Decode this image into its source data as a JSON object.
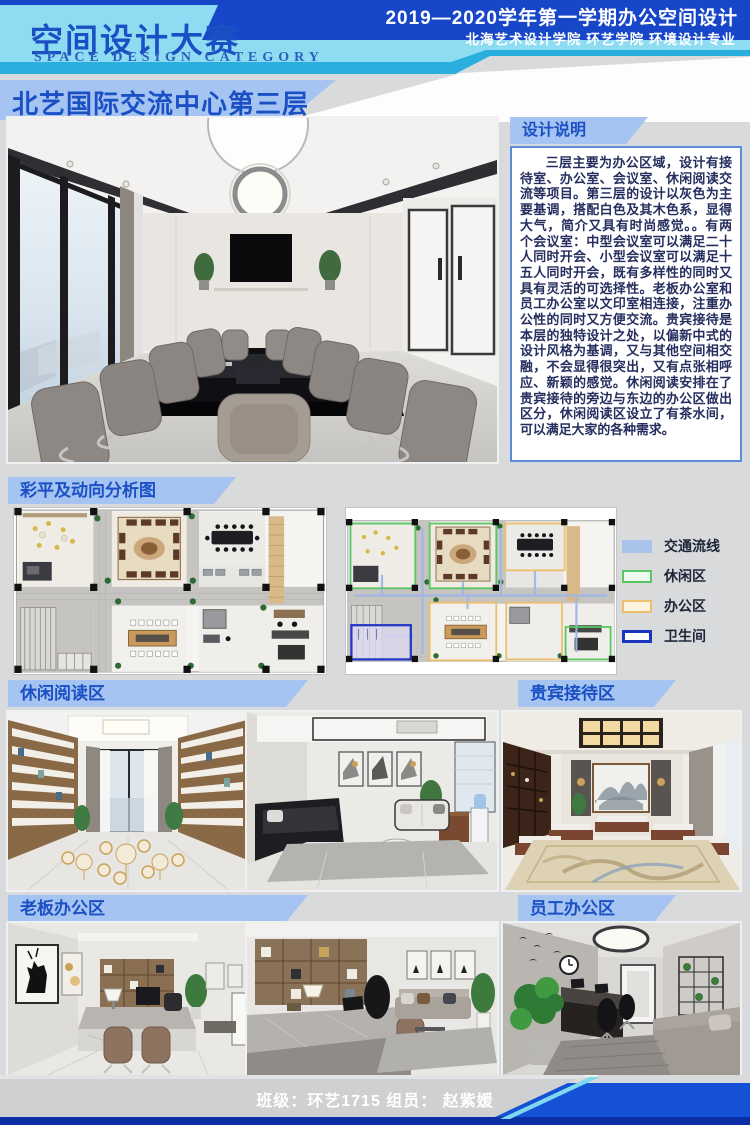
{
  "header": {
    "title": "空间设计大赛",
    "subtitle": "SPACE DESIGN CATEGORY",
    "session_line": "2019—2020学年第一学期办公空间设计",
    "school_line": "北海艺术设计学院 环艺学院 环境设计专业",
    "banner_main": "北艺国际交流中心",
    "banner_em": "第三层",
    "colors": {
      "royal_blue": "#1746c8",
      "light_cyan": "#8edcf2",
      "cyan_strip": "#29aede",
      "periwinkle": "#a6c4f1",
      "title_blue": "#1b50c5"
    }
  },
  "design_notes": {
    "label": "设计说明",
    "text": "三层主要为办公区域，设计有接待室、办公室、会议室、休闲阅读交流等项目。第三层的设计以灰色为主要基调，搭配白色及其木色系，显得大气，简介又具有时尚感觉。。有两个会议室：中型会议室可以满足二十人同时开会、小型会议室可以满足十五人同时开会，既有多样性的同时又具有灵活的可选择性。老板办公室和员工办公室以文印室相连接，注重办公性的同时又方便交流。贵宾接待是本层的独特设计之处，以偏新中式的设计风格为基调，又与其他空间相交融，不会显得很突出，又有点张相呼应、新颖的感觉。休闲阅读安排在了贵宾接待的旁边与东边的办公区做出区分，休闲阅读区设立了有茶水间，可以满足大家的各种需求。"
  },
  "analysis": {
    "label": "彩平及动向分析图",
    "legend": [
      {
        "name": "交通流线",
        "color": "#a9c3ea",
        "style": "solid"
      },
      {
        "name": "休闲区",
        "color": "#58c763",
        "style": "outline"
      },
      {
        "name": "办公区",
        "color": "#edbf6d",
        "style": "outline"
      },
      {
        "name": "卫生间",
        "color": "#1b35bd",
        "style": "outline-thick"
      }
    ]
  },
  "sections": [
    {
      "label": "休闲阅读区"
    },
    {
      "label": "贵宾接待区"
    },
    {
      "label": "老板办公区"
    },
    {
      "label": "员工办公区"
    }
  ],
  "footer": {
    "text": "班级：环艺1715 组员： 赵紫媛",
    "bar_color": "#1551d4"
  }
}
